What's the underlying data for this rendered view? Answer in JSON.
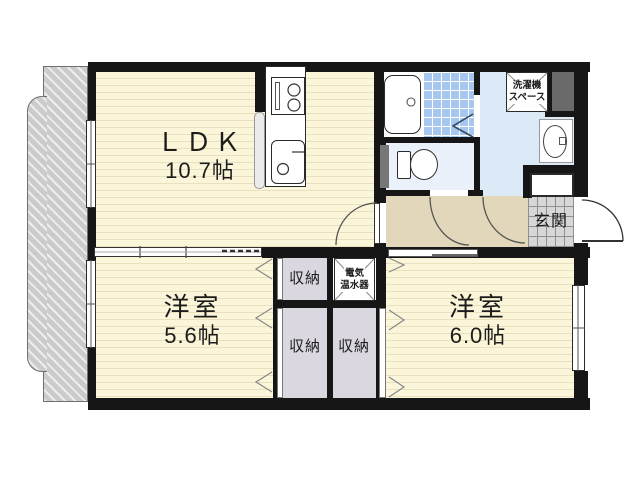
{
  "plan": {
    "rooms": {
      "ldk": {
        "name": "ＬＤＫ",
        "area": "10.7帖"
      },
      "bedroom_west": {
        "name": "洋室",
        "area": "5.6帖"
      },
      "bedroom_east": {
        "name": "洋室",
        "area": "6.0帖"
      }
    },
    "entrance_label": "玄関",
    "closet_top_label": "収納",
    "closet_left_label": "収納",
    "closet_right_label": "収納",
    "water_heater": {
      "line1": "電気",
      "line2": "温水器"
    },
    "washer_space": {
      "line1": "洗濯機",
      "line2": "スペース"
    },
    "colors": {
      "wall": "#161616",
      "room_floor": "#FBF6D9",
      "room_stripe": "#E8E0BE",
      "hallway_floor": "#E2D6BB",
      "closet_floor": "#DAD7E0",
      "washroom_floor": "#DCE9F7",
      "toilet_floor": "#EAF1FA",
      "bath_tile": "#A6C8F0",
      "entrance_tile": "#D7D7D7",
      "balcony": "#CBCBCB",
      "shaft": "#6A6A6A"
    }
  }
}
